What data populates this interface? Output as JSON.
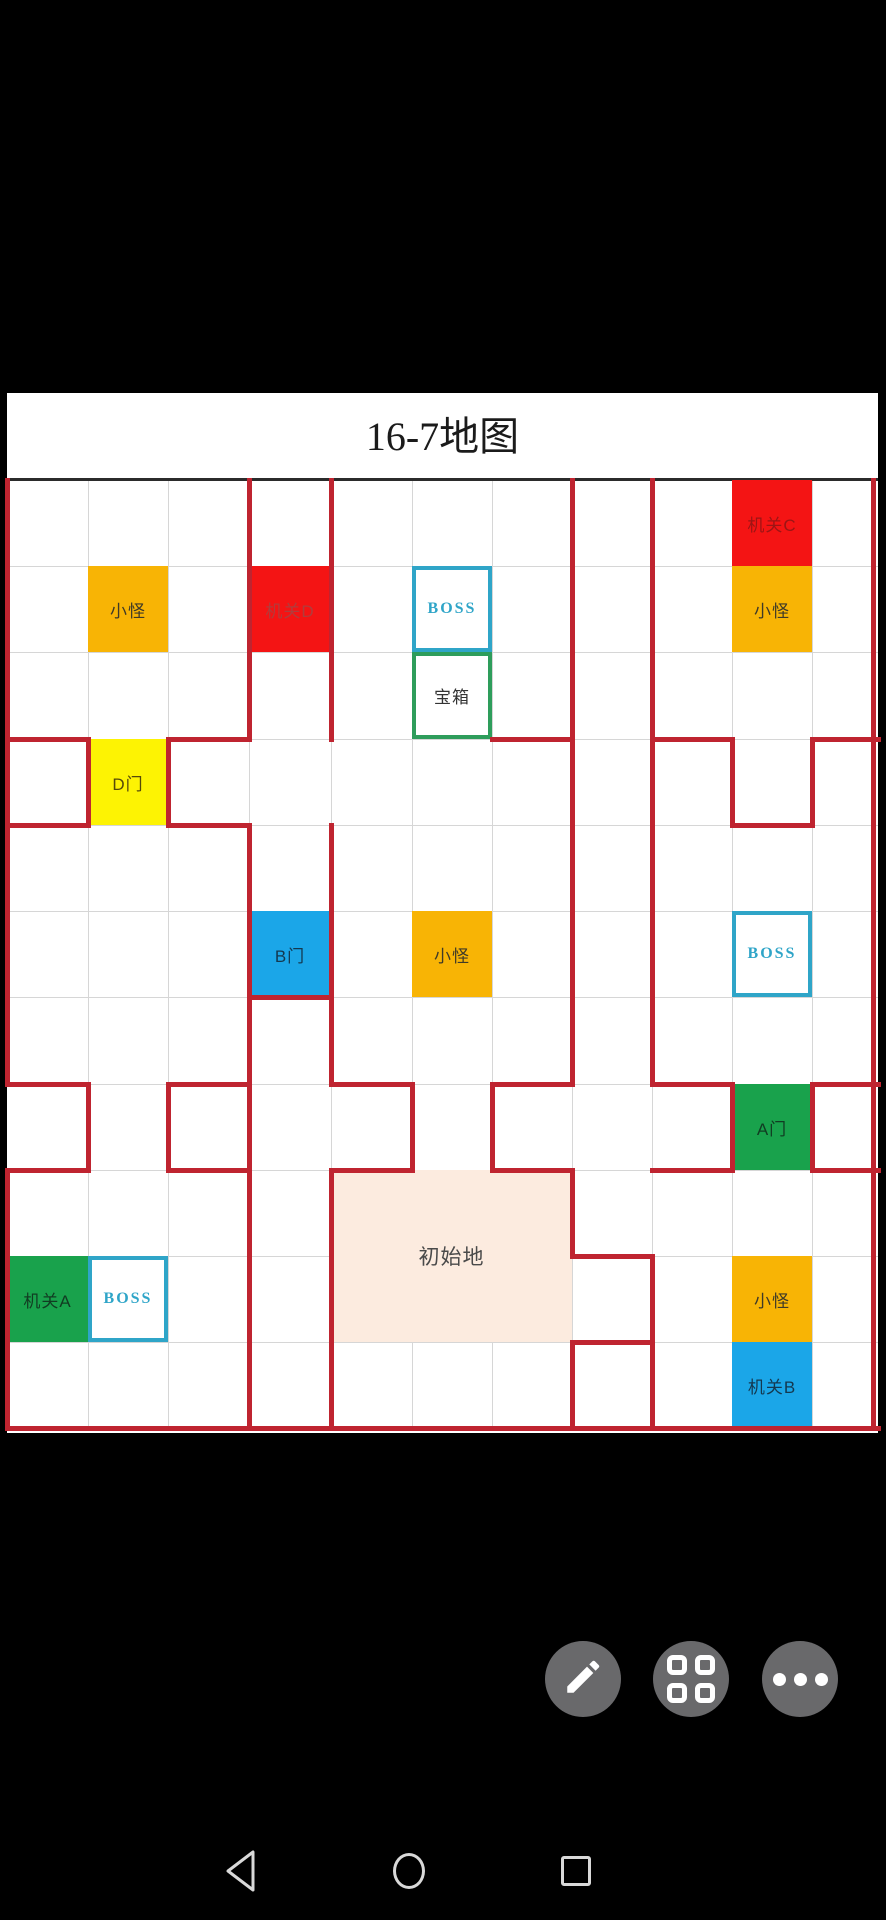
{
  "title": "16-7地图",
  "map": {
    "panel": {
      "left": 7,
      "top": 393,
      "width": 871,
      "height": 1040
    },
    "title_band_height": 87,
    "title_font_size": 40,
    "col_lines": [
      7,
      88,
      168,
      249,
      331,
      412,
      492,
      572,
      652,
      732,
      812,
      873
    ],
    "row_lines": [
      480,
      566,
      652,
      739,
      825,
      911,
      997,
      1084,
      1170,
      1256,
      1342,
      1428
    ],
    "colors": {
      "path_red": "#bf2430",
      "cell_red": "#f41414",
      "orange": "#f8b405",
      "yellow": "#fdf303",
      "blue": "#1ba6e8",
      "green": "#19a24c",
      "pink": "#fcebdf",
      "boss_border": "#2fa5c8",
      "chest_border": "#2e9d5b",
      "grid_line": "#d6d6d6"
    },
    "cells": [
      {
        "name": "trap-c",
        "label": "机关C",
        "col": 9,
        "row": 0,
        "type": "red",
        "text_color": "#9c1515"
      },
      {
        "name": "monster-top-right",
        "label": "小怪",
        "col": 9,
        "row": 1,
        "type": "orange",
        "text_color": "#3f3a28"
      },
      {
        "name": "monster-top-left",
        "label": "小怪",
        "col": 1,
        "row": 1,
        "type": "orange",
        "text_color": "#3f3a28"
      },
      {
        "name": "trap-d",
        "label": "机关D",
        "col": 3,
        "row": 1,
        "type": "red",
        "text_color": "#b23c3c"
      },
      {
        "name": "boss-top",
        "label": "BOSS",
        "col": 5,
        "row": 1,
        "type": "boss",
        "text_color": "#2fa5c8"
      },
      {
        "name": "treasure-chest",
        "label": "宝箱",
        "col": 5,
        "row": 2,
        "type": "chest",
        "text_color": "#333333"
      },
      {
        "name": "door-d",
        "label": "D门",
        "col": 1,
        "row": 3,
        "type": "yellow",
        "text_color": "#55490a"
      },
      {
        "name": "door-b",
        "label": "B门",
        "col": 3,
        "row": 5,
        "type": "blue",
        "text_color": "#14384f"
      },
      {
        "name": "monster-middle",
        "label": "小怪",
        "col": 5,
        "row": 5,
        "type": "orange",
        "text_color": "#3f3a28"
      },
      {
        "name": "boss-right",
        "label": "BOSS",
        "col": 9,
        "row": 5,
        "type": "boss",
        "text_color": "#2fa5c8"
      },
      {
        "name": "door-a",
        "label": "A门",
        "col": 9,
        "row": 7,
        "type": "green",
        "text_color": "#113c22"
      },
      {
        "name": "start-area",
        "label": "初始地",
        "col": 4,
        "row": 8,
        "colspan": 3,
        "rowspan": 2,
        "type": "start",
        "text_color": "#4a4a4a"
      },
      {
        "name": "trap-a",
        "label": "机关A",
        "col": 0,
        "row": 9,
        "type": "green",
        "text_color": "#113c22"
      },
      {
        "name": "boss-bottom-left",
        "label": "BOSS",
        "col": 1,
        "row": 9,
        "type": "boss",
        "text_color": "#2fa5c8"
      },
      {
        "name": "monster-bottom-right",
        "label": "小怪",
        "col": 9,
        "row": 9,
        "type": "orange",
        "text_color": "#3f3a28"
      },
      {
        "name": "trap-b",
        "label": "机关B",
        "col": 9,
        "row": 10,
        "type": "blue",
        "text_color": "#14384f"
      }
    ],
    "red_segments": {
      "thickness": 5,
      "vertical": [
        [
          7,
          480,
          1084
        ],
        [
          7,
          1170,
          1428
        ],
        [
          88,
          739,
          825
        ],
        [
          88,
          1084,
          1170
        ],
        [
          168,
          739,
          825
        ],
        [
          168,
          1084,
          1170
        ],
        [
          249,
          480,
          739
        ],
        [
          249,
          825,
          1428
        ],
        [
          331,
          480,
          739
        ],
        [
          331,
          825,
          1084
        ],
        [
          331,
          1170,
          1428
        ],
        [
          412,
          1084,
          1170
        ],
        [
          492,
          1084,
          1170
        ],
        [
          572,
          480,
          1084
        ],
        [
          572,
          1170,
          1256
        ],
        [
          572,
          1342,
          1428
        ],
        [
          652,
          480,
          1084
        ],
        [
          652,
          1256,
          1428
        ],
        [
          732,
          739,
          825
        ],
        [
          732,
          1084,
          1170
        ],
        [
          812,
          739,
          825
        ],
        [
          812,
          1084,
          1170
        ],
        [
          873,
          480,
          1428
        ]
      ],
      "horizontal": [
        [
          739,
          7,
          88
        ],
        [
          739,
          168,
          249
        ],
        [
          739,
          492,
          572
        ],
        [
          739,
          652,
          732
        ],
        [
          739,
          812,
          878
        ],
        [
          825,
          7,
          88
        ],
        [
          825,
          168,
          249
        ],
        [
          825,
          732,
          812
        ],
        [
          997,
          249,
          331
        ],
        [
          1084,
          7,
          88
        ],
        [
          1084,
          168,
          249
        ],
        [
          1084,
          331,
          412
        ],
        [
          1084,
          492,
          572
        ],
        [
          1084,
          652,
          732
        ],
        [
          1084,
          812,
          878
        ],
        [
          1170,
          7,
          88
        ],
        [
          1170,
          168,
          249
        ],
        [
          1170,
          331,
          412
        ],
        [
          1170,
          492,
          572
        ],
        [
          1170,
          652,
          732
        ],
        [
          1170,
          812,
          878
        ],
        [
          1256,
          572,
          652
        ],
        [
          1342,
          572,
          652
        ],
        [
          1428,
          7,
          878
        ]
      ]
    }
  },
  "fab_buttons": [
    {
      "name": "edit-button",
      "icon": "pencil-icon",
      "cx": 583,
      "cy": 1679
    },
    {
      "name": "apps-button",
      "icon": "apps-grid-icon",
      "cx": 691,
      "cy": 1679
    },
    {
      "name": "more-button",
      "icon": "ellipsis-icon",
      "cx": 800,
      "cy": 1679
    }
  ],
  "navbar": [
    {
      "name": "nav-back",
      "icon": "back-triangle-icon",
      "cx": 242,
      "cy": 1871
    },
    {
      "name": "nav-home",
      "icon": "home-circle-icon",
      "cx": 409,
      "cy": 1871
    },
    {
      "name": "nav-recents",
      "icon": "recents-square-icon",
      "cx": 576,
      "cy": 1871
    }
  ]
}
